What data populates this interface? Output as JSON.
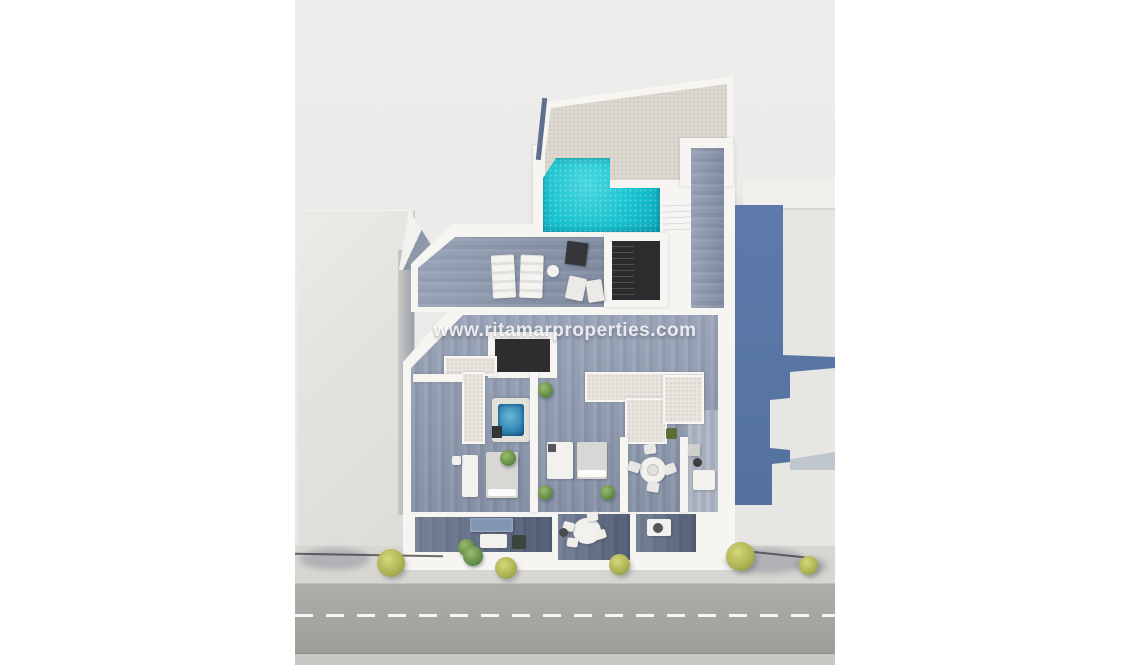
{
  "image": {
    "type": "3d-aerial-floorplan-render",
    "watermark": "www.ritamarproperties.com"
  },
  "palette": {
    "wall_white": "#f6f5f2",
    "background": "#ecebe9",
    "pool_water": "#18c2cf",
    "pool_water_deep": "#0ca9c0",
    "jacuzzi_water": "#2f86b5",
    "deck_wood": "#8c98ae",
    "balcony_wood": "#5f6c83",
    "roof_tile": "#dcd8d0",
    "terrace_tile": "#e9e5de",
    "stairwell_dark": "#2c2b2d",
    "building_shadow_blue": "#5d7aab",
    "neighbor_building": "#e4e3e0",
    "road": "#a7a6a1",
    "sidewalk": "#d8d6d1",
    "road_marking": "#ffffff",
    "tree_foliage": "#b5bb5e"
  }
}
